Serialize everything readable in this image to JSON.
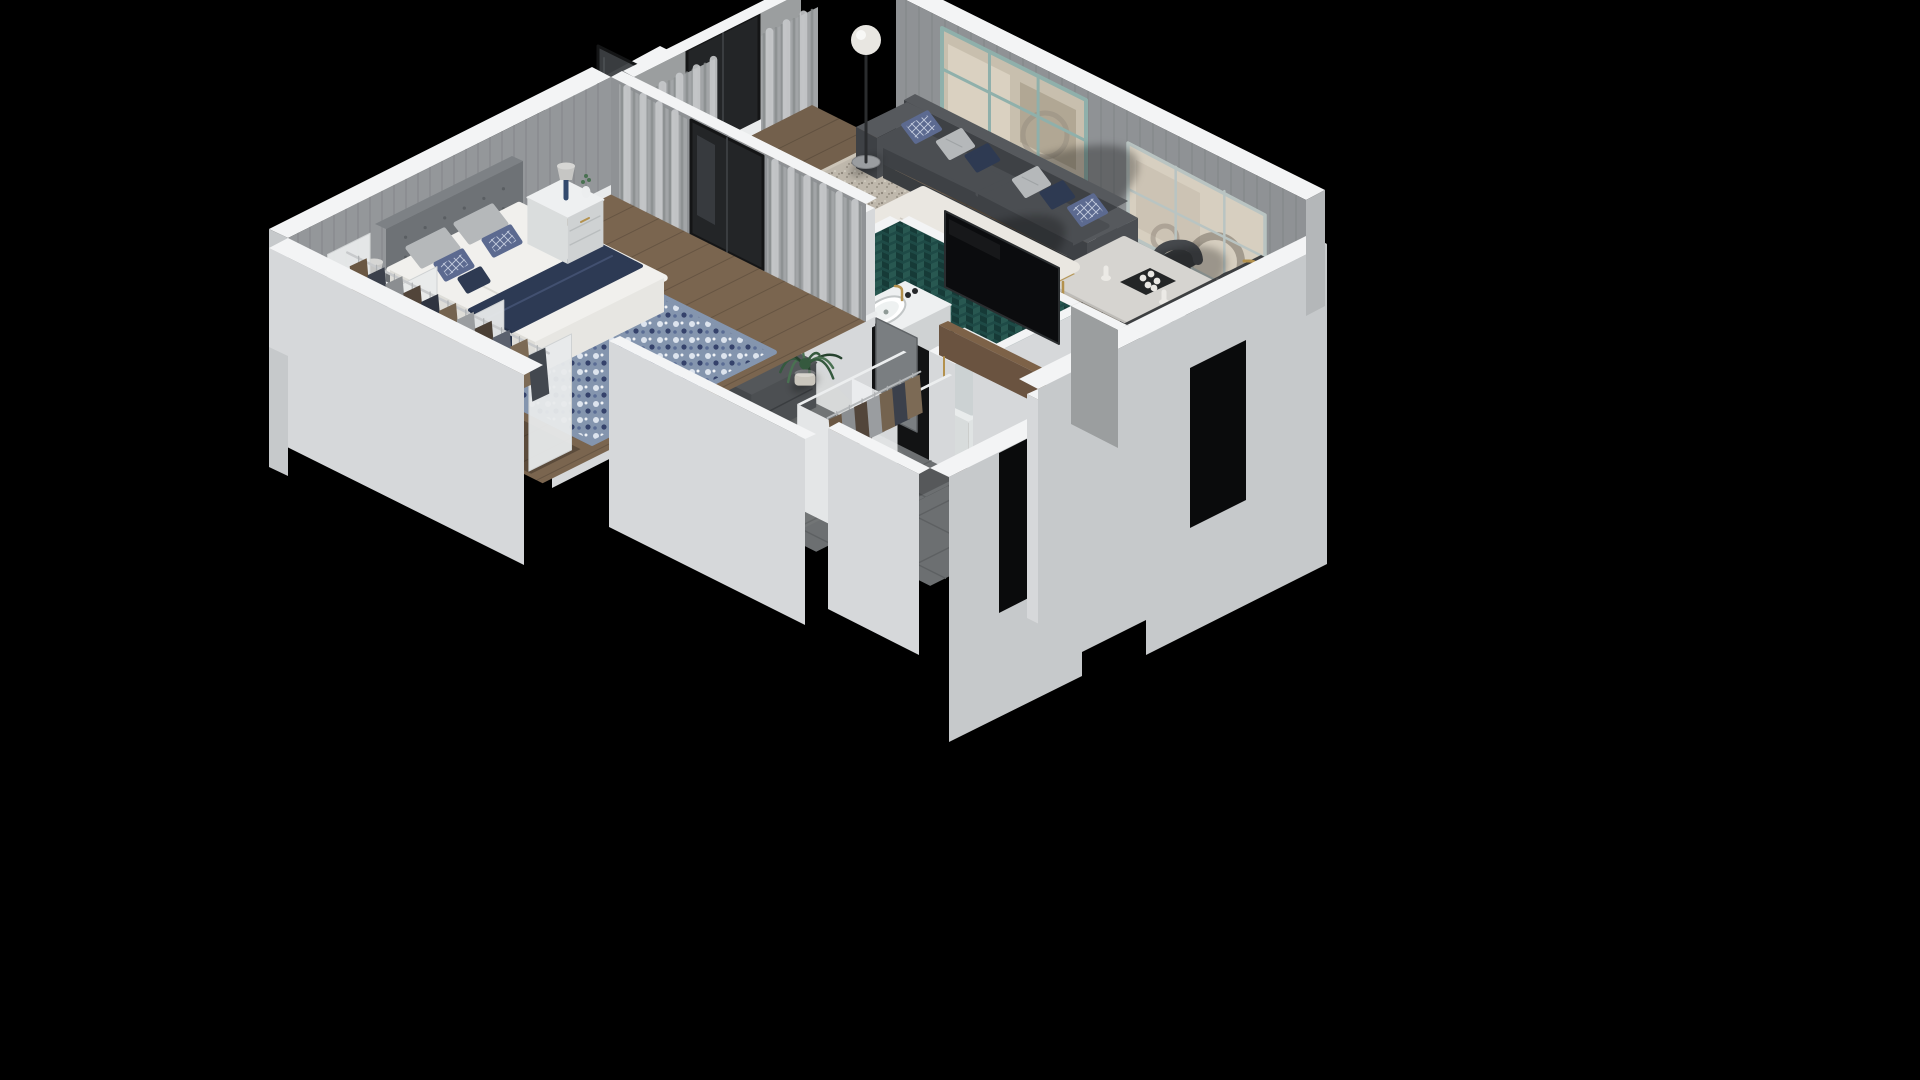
{
  "meta": {
    "title": "Isometric 3D floor plan render of a one-bedroom apartment on a black background",
    "view": "isometric-cutaway-3d-floorplan",
    "background": "#000000"
  },
  "palette": {
    "bg": "#000000",
    "wallTop": "#f3f4f5",
    "wallTopShade": "#e8eaeb",
    "extLight": "#d6d8da",
    "extMid": "#c6c9cb",
    "extShade": "#b4b7b9",
    "wallFace": "#8f9295",
    "wallFaceLight": "#9b9e9f",
    "baseboard": "#e9ebec",
    "woodBedroom": "#7a654f",
    "woodLiving": "#73604c",
    "woodBath": "#4b3d31",
    "woodBalcony": "#675543",
    "tile": "#6c6f71",
    "grout": "#5d6062",
    "rugCream": "#cbc4b7",
    "rugFleckDark": "#968f83",
    "rugFleckLight": "#f0ebdd",
    "rugBlue": "#8495ae",
    "rugBlueDark": "#35426b",
    "rugBlueLight": "#dde4ee",
    "teal": "#1e4a46",
    "tealDark": "#163a37",
    "tealLight": "#2a5b54",
    "tealFrame": "#8fb0ab",
    "sofa": "#4b4e52",
    "sofaDark": "#3e4145",
    "sofaLight": "#56595d",
    "pillowTrellis": "#5c6a90",
    "pillowTrellisLine": "#c2cadd",
    "pillowGray": "#b5b8ba",
    "pillowNavy": "#2e3a52",
    "marble": "#eae7e1",
    "marbleVein": "#b9b4aa",
    "gold": "#b3914d",
    "stoneTable": "#d6d4d0",
    "stoneSide": "#bebcb8",
    "chair": "#3a3d40",
    "chairDark": "#2c2f32",
    "counter": "#3d3f41",
    "counterFront": "#54575a",
    "cooktop": "#ebebe9",
    "tv": "#0b0c0e",
    "glassDoor": "#232527",
    "glassFrame": "#141516",
    "screenGlass": "#3c3f42",
    "curtain": "#a2a5a7",
    "curtainStripe": "#8a8d8f",
    "curtainLight": "#c6c9cb",
    "mirrorWarm": "#d7cfc0",
    "mirrorVein": "#c3baa9",
    "mirrorSmudge": "#6f675c",
    "globe": "#e8e6e1",
    "metal": "#2a2c2e",
    "plant": "#35593e",
    "plantDark": "#26422e",
    "plantLight": "#4a7152",
    "duvet": "#f1f0ed",
    "duvetShade": "#deddd8",
    "navy": "#2d3a54",
    "navyDark": "#232f47",
    "headboard": "#6e7276",
    "headboardTop": "#7d8185",
    "whiteFurn": "#eef0f1",
    "whiteFurnShade": "#dadddd",
    "whiteFurnSide": "#cfd2d3",
    "bench": "#54575a",
    "benchDark": "#45484b",
    "door": "#7a7e81",
    "lampNavy": "#334a6e",
    "potWhite": "#cac6bd",
    "potGray": "#8e8f90",
    "opening": "#0a0b0c",
    "shadow": "#000000"
  },
  "scene": {
    "rooms": [
      {
        "name": "bedroom",
        "floor": "wood",
        "furniture": [
          "double-bed-white-duvet-navy-throw",
          "gray-tufted-headboard",
          "gray-pillows",
          "blue-patterned-pillows",
          "blue-floral-rug",
          "nightstand-left-with-lamp",
          "nightstand-right-with-lamp-and-vase",
          "open-closet-rack-with-hanging-clothes",
          "sheer-curtains",
          "balcony-glass-door"
        ]
      },
      {
        "name": "balcony",
        "floor": "wood-slats",
        "furniture": [
          "tall-dark-glass-screen",
          "glass-railing",
          "potted-plant",
          "white-parapet-stub"
        ]
      },
      {
        "name": "living-room",
        "floor": "wood",
        "furniture": [
          "dark-gray-sofa",
          "trellis-navy-and-gray-cushions",
          "white-marble-coffee-table-gold-frame",
          "black-swan-decor",
          "blue-gray-ottoman",
          "cream-speckled-rug",
          "globe-floor-lamp",
          "teal-framed-window",
          "six-pane-wall-mirror",
          "gray-curtains",
          "balcony-glass-door",
          "potted-palms"
        ]
      },
      {
        "name": "dining-area",
        "floor": "wood",
        "furniture": [
          "stone-dining-table",
          "four-dark-chairs",
          "centerpiece-tray-white-roses-candles"
        ]
      },
      {
        "name": "kitchen",
        "floor": "wood",
        "furniture": [
          "dark-counter-run",
          "white-cooktop-with-knobs",
          "sink-with-gold-faucet",
          "bottles"
        ]
      },
      {
        "name": "bathroom",
        "floor": "dark-wood",
        "furniture": [
          "teal-herringbone-tile-walls",
          "white-vanity-with-oval-sink",
          "gold-faucet",
          "towel",
          "bathtub",
          "wall-mounted-tv-facing-living-room",
          "wood-media-console",
          "swing-door"
        ]
      },
      {
        "name": "hallway",
        "floor": "gray-tile",
        "furniture": [
          "upholstered-storage-bench-with-white-pillows",
          "round-dark-wall-mirror",
          "potted-palm",
          "bedroom-swing-door"
        ]
      },
      {
        "name": "entry",
        "floor": "gray-tile",
        "furniture": [
          "open-wardrobe-with-hanging-clothes",
          "dark-door-opening"
        ]
      }
    ],
    "walls": {
      "cut": "white-topped cutaway walls",
      "exterior": "light gray faces",
      "interiorFinish": "gray vertical paneling"
    }
  }
}
